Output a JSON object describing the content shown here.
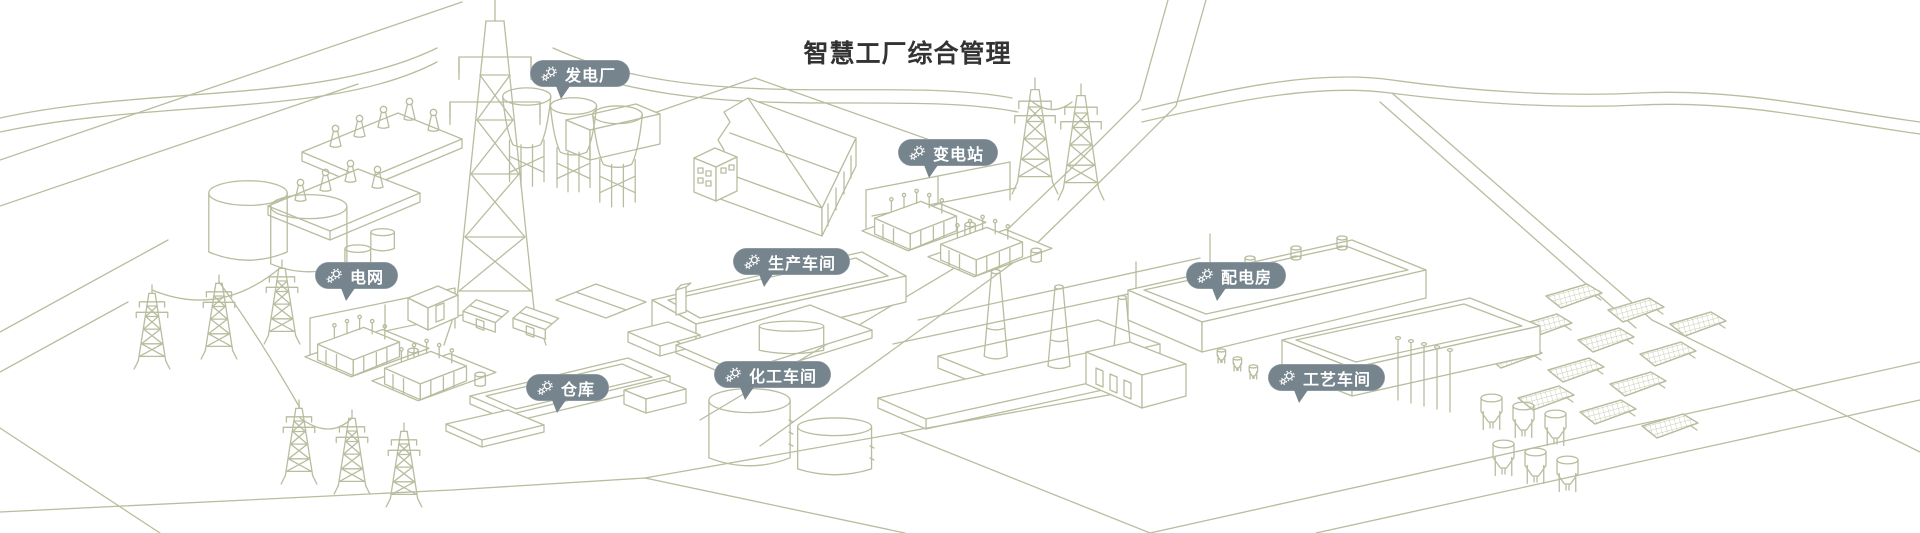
{
  "page": {
    "title": "智慧工厂综合管理"
  },
  "colors": {
    "background": "#ffffff",
    "line_art": "#b7bd9e",
    "badge_background": "#76848e",
    "badge_text": "#ffffff",
    "title_text": "#333333"
  },
  "markers": [
    {
      "id": "power-plant",
      "label": "发电厂",
      "icon": "gears-icon",
      "x": 530,
      "y": 60
    },
    {
      "id": "substation",
      "label": "变电站",
      "icon": "gears-icon",
      "x": 898,
      "y": 139
    },
    {
      "id": "power-grid",
      "label": "电网",
      "icon": "gears-icon",
      "x": 315,
      "y": 262
    },
    {
      "id": "production-workshop",
      "label": "生产车间",
      "icon": "gears-icon",
      "x": 733,
      "y": 248
    },
    {
      "id": "power-distribution-room",
      "label": "配电房",
      "icon": "gears-icon",
      "x": 1186,
      "y": 262
    },
    {
      "id": "warehouse",
      "label": "仓库",
      "icon": "gears-icon",
      "x": 526,
      "y": 374
    },
    {
      "id": "chemical-workshop",
      "label": "化工车间",
      "icon": "gears-icon",
      "x": 714,
      "y": 361
    },
    {
      "id": "process-workshop",
      "label": "工艺车间",
      "icon": "gears-icon",
      "x": 1268,
      "y": 364
    }
  ],
  "illustration": {
    "style": "isometric line-art, sage green strokes on white",
    "scene_elements": [
      "transmission-towers",
      "power-lines",
      "transformer-yard",
      "cooling-towers",
      "storage-tanks",
      "sawtooth-factory-building",
      "substation-equipment",
      "production-workshop-building",
      "distribution-building",
      "chimneys",
      "loading-dock-building",
      "solar-panel-array",
      "process-workshop-building",
      "silo-cluster",
      "warehouse-slab",
      "chemical-storage-tanks",
      "roads"
    ]
  }
}
